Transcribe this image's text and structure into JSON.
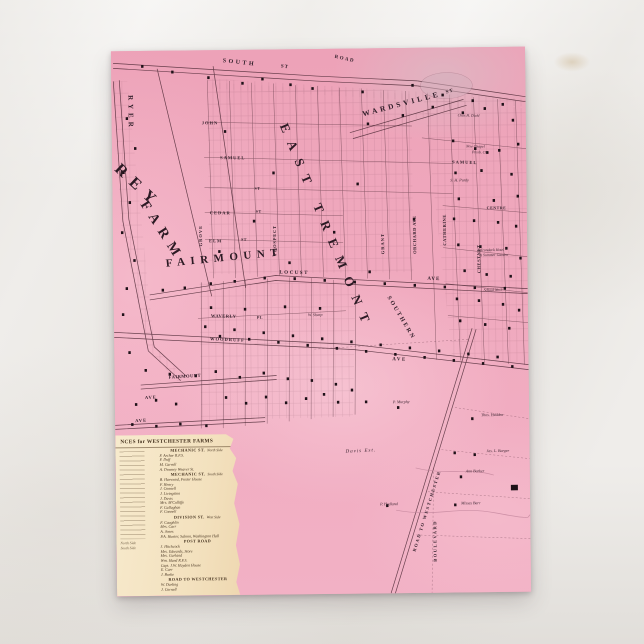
{
  "postcard": {
    "description": "Vintage pink cadastral map postcard of East Tremont, Wardsville and Westchester Farms",
    "colors": {
      "map_pink": "#efa6bb",
      "map_pink_light": "#f7c6d4",
      "ink": "#4a2733",
      "building": "#1e1118",
      "card_cream": "#f3e1be",
      "card_ink": "#43301d"
    }
  },
  "map": {
    "labels": [
      {
        "id": "south",
        "text": "SOUTH",
        "x": 112,
        "y": 8,
        "rot": 7,
        "fs": 6,
        "ls": 2.5
      },
      {
        "id": "south-st",
        "text": "ST",
        "x": 170,
        "y": 15,
        "rot": 7,
        "fs": 5,
        "ls": 1
      },
      {
        "id": "road",
        "text": "ROAD",
        "x": 224,
        "y": 6,
        "rot": 13,
        "fs": 5,
        "ls": 1.5
      },
      {
        "id": "wardsville",
        "text": "WARDSVILLE",
        "x": 250,
        "y": 62,
        "rot": -14,
        "fs": 7.5,
        "ls": 3
      },
      {
        "id": "wardsville-st",
        "text": "ST",
        "x": 334,
        "y": 43,
        "rot": -14,
        "fs": 5,
        "ls": 1
      },
      {
        "id": "east-tremont",
        "text": "EAST TREMONT",
        "x": 178,
        "y": 72,
        "rot": 68,
        "fs": 13,
        "ls": 10,
        "xl": true
      },
      {
        "id": "ryer",
        "text": "RYER",
        "x": 22,
        "y": 44,
        "rot": 90,
        "fs": 7,
        "ls": 4
      },
      {
        "id": "rey",
        "text": "REY",
        "x": 10,
        "y": 110,
        "rot": 44,
        "fs": 16,
        "ls": 8,
        "xl": true
      },
      {
        "id": "farm",
        "text": "FARM",
        "x": 36,
        "y": 148,
        "rot": 58,
        "fs": 14,
        "ls": 7,
        "xl": true
      },
      {
        "id": "fairmount",
        "text": "FAIRMOUNT",
        "x": 52,
        "y": 208,
        "rot": -5,
        "fs": 11,
        "ls": 5.5,
        "xl": true
      },
      {
        "id": "john",
        "text": "JOHN",
        "x": 90,
        "y": 71,
        "rot": 1,
        "fs": 4.5,
        "ls": 1
      },
      {
        "id": "samuel-w",
        "text": "SAMUEL",
        "x": 108,
        "y": 106,
        "rot": 1,
        "fs": 4.5,
        "ls": 1
      },
      {
        "id": "st-mid",
        "text": "ST",
        "x": 142,
        "y": 137,
        "rot": 0,
        "fs": 4,
        "ls": 0.5
      },
      {
        "id": "cedar",
        "text": "CEDAR",
        "x": 97,
        "y": 161,
        "rot": 1,
        "fs": 4.5,
        "ls": 1
      },
      {
        "id": "cedar-st",
        "text": "ST",
        "x": 143,
        "y": 160,
        "rot": 0,
        "fs": 4,
        "ls": 0.5
      },
      {
        "id": "elm",
        "text": "ELM",
        "x": 96,
        "y": 189,
        "rot": 1,
        "fs": 4.5,
        "ls": 1
      },
      {
        "id": "elm-st",
        "text": "ST",
        "x": 128,
        "y": 188,
        "rot": 0,
        "fs": 4,
        "ls": 0.5
      },
      {
        "id": "grove",
        "text": "GROVE",
        "x": 86,
        "y": 196,
        "rot": -90,
        "fs": 4.5,
        "ls": 1
      },
      {
        "id": "prospect",
        "text": "PROSPECT",
        "x": 160,
        "y": 206,
        "rot": -90,
        "fs": 4.5,
        "ls": 0.8
      },
      {
        "id": "locust",
        "text": "LOCUST",
        "x": 166,
        "y": 221,
        "rot": 2,
        "fs": 5,
        "ls": 1.5
      },
      {
        "id": "locust-ave",
        "text": "AVE",
        "x": 314,
        "y": 229,
        "rot": 2,
        "fs": 5,
        "ls": 1
      },
      {
        "id": "southern",
        "text": "SOUTHERN",
        "x": 277,
        "y": 247,
        "rot": 60,
        "fs": 6,
        "ls": 2
      },
      {
        "id": "waverly",
        "text": "WAVERLY",
        "x": 97,
        "y": 264,
        "rot": 2,
        "fs": 4.5,
        "ls": 0.5
      },
      {
        "id": "waverly-pl",
        "text": "PL",
        "x": 143,
        "y": 266,
        "rot": 2,
        "fs": 4,
        "ls": 0.5
      },
      {
        "id": "woodruff",
        "text": "WOODRUFF",
        "x": 96,
        "y": 287,
        "rot": 3,
        "fs": 4.5,
        "ls": 1
      },
      {
        "id": "ave-main",
        "text": "AVE",
        "x": 278,
        "y": 309,
        "rot": 3,
        "fs": 5,
        "ls": 1.5
      },
      {
        "id": "fairmount-st",
        "text": "FAIRMOUNT",
        "x": 54,
        "y": 325,
        "rot": -3,
        "fs": 4.5,
        "ls": 0.5
      },
      {
        "id": "ave-low",
        "text": "AVE",
        "x": 30,
        "y": 345,
        "rot": -2,
        "fs": 4.5,
        "ls": 1
      },
      {
        "id": "ave-lowest",
        "text": "AVE",
        "x": 20,
        "y": 368,
        "rot": -2,
        "fs": 4.5,
        "ls": 1
      },
      {
        "id": "grant",
        "text": "GRANT",
        "x": 268,
        "y": 206,
        "rot": -90,
        "fs": 4.5,
        "ls": 1
      },
      {
        "id": "orchard-ave",
        "text": "ORCHARD AVE",
        "x": 300,
        "y": 206,
        "rot": -90,
        "fs": 4.5,
        "ls": 0.5
      },
      {
        "id": "catherine",
        "text": "CATHERINE",
        "x": 330,
        "y": 198,
        "rot": -90,
        "fs": 4.5,
        "ls": 0.5
      },
      {
        "id": "chestnut",
        "text": "CHESTNUT",
        "x": 364,
        "y": 226,
        "rot": -90,
        "fs": 4.5,
        "ls": 0.5
      },
      {
        "id": "samuel-e",
        "text": "SAMUEL",
        "x": 340,
        "y": 113,
        "rot": 2,
        "fs": 4.5,
        "ls": 1
      },
      {
        "id": "centre",
        "text": "CENTRE",
        "x": 374,
        "y": 159,
        "rot": 1,
        "fs": 4,
        "ls": 0.5
      },
      {
        "id": "purdy",
        "text": "S. H. Purdy",
        "x": 338,
        "y": 131,
        "rot": 0,
        "fs": 4,
        "it": true
      },
      {
        "id": "chapel-1",
        "text": "New Chapel",
        "x": 354,
        "y": 98,
        "rot": 2,
        "fs": 3.8,
        "it": true
      },
      {
        "id": "chapel-2",
        "text": "Presb. Ch.",
        "x": 360,
        "y": 104,
        "rot": 2,
        "fs": 3.8,
        "it": true
      },
      {
        "id": "diehl",
        "text": "Chas H. Diehl",
        "x": 346,
        "y": 67,
        "rot": 2,
        "fs": 3.8,
        "it": true
      },
      {
        "id": "adirondack-1",
        "text": "Adirondack Hotel",
        "x": 364,
        "y": 202,
        "rot": 0,
        "fs": 3.8,
        "it": true
      },
      {
        "id": "adirondack-2",
        "text": "& Summer Garden",
        "x": 366,
        "y": 207,
        "rot": 0,
        "fs": 3.8,
        "it": true
      },
      {
        "id": "school",
        "text": "School No.2",
        "x": 370,
        "y": 242,
        "rot": 0,
        "fs": 3.8,
        "it": true
      },
      {
        "id": "davis-est",
        "text": "Davis Est.",
        "x": 230,
        "y": 401,
        "rot": -2,
        "fs": 5,
        "ls": 1,
        "it": true
      },
      {
        "id": "sharp",
        "text": "W. Sharp",
        "x": 194,
        "y": 264,
        "rot": 0,
        "fs": 4,
        "it": true
      },
      {
        "id": "murphy",
        "text": "P. Murphy",
        "x": 278,
        "y": 352,
        "rot": 0,
        "fs": 4,
        "it": true
      },
      {
        "id": "hedden",
        "text": "Thos. Hedden",
        "x": 366,
        "y": 366,
        "rot": 0,
        "fs": 4,
        "it": true
      },
      {
        "id": "barger",
        "text": "Jas. L. Barger",
        "x": 371,
        "y": 402,
        "rot": 0,
        "fs": 4,
        "it": true
      },
      {
        "id": "barker",
        "text": "Ann Barker",
        "x": 350,
        "y": 422,
        "rot": 0,
        "fs": 4,
        "it": true
      },
      {
        "id": "barr",
        "text": "Misses Barr",
        "x": 345,
        "y": 454,
        "rot": 0,
        "fs": 4,
        "it": true
      },
      {
        "id": "hedland",
        "text": "P. Hedland",
        "x": 264,
        "y": 454,
        "rot": 0,
        "fs": 4,
        "it": true
      },
      {
        "id": "road-to-westchester",
        "text": "ROAD TO WESTCHESTER",
        "x": 296,
        "y": 503,
        "rot": -72,
        "fs": 4.5,
        "ls": 1.5
      },
      {
        "id": "boulevard",
        "text": "BOULEVARD",
        "x": 317,
        "y": 514,
        "rot": -90,
        "fs": 4.5,
        "ls": 1.5
      }
    ]
  },
  "reference_card": {
    "title": "NCES for WESTCHESTER FARMS",
    "left_column_fragments": [
      "North Side",
      "South Side"
    ],
    "sections": [
      {
        "header": "MECHANIC ST.",
        "side": "North Side",
        "entries": [
          "F. Archer  R.F.S.",
          "F. Duff",
          "M. Carroll",
          "A. Downey  Weaver St."
        ]
      },
      {
        "header": "MECHANIC ST.",
        "side": "South Side",
        "entries": [
          "B. Harwood, Foster House",
          "F. Henry",
          "J. Connell",
          "J. Livingston",
          "J. Davis",
          "Mrs. M'Culliffe",
          "F. Callaghan",
          "F. Connell"
        ]
      },
      {
        "header": "DIVISION ST.",
        "side": "West Side",
        "entries": [
          "F. Caughlin",
          "Mrs. Carr",
          "A. Jones",
          "P.A. Hunter, Saloon, Washington Hall"
        ]
      },
      {
        "header": "POST ROAD",
        "side": "",
        "entries": [
          "J. Hitchcock",
          "Mrs. Edwards, Store",
          "Mrs. Garland",
          "Wm. Hand  R.F.S.",
          "Capt. J.W. Hayden House",
          "E. Carr",
          "J. Burke"
        ]
      },
      {
        "header": "ROAD TO WESTCHESTER",
        "side": "",
        "entries": [
          "W. Darling",
          "J. Cornell"
        ]
      }
    ]
  }
}
